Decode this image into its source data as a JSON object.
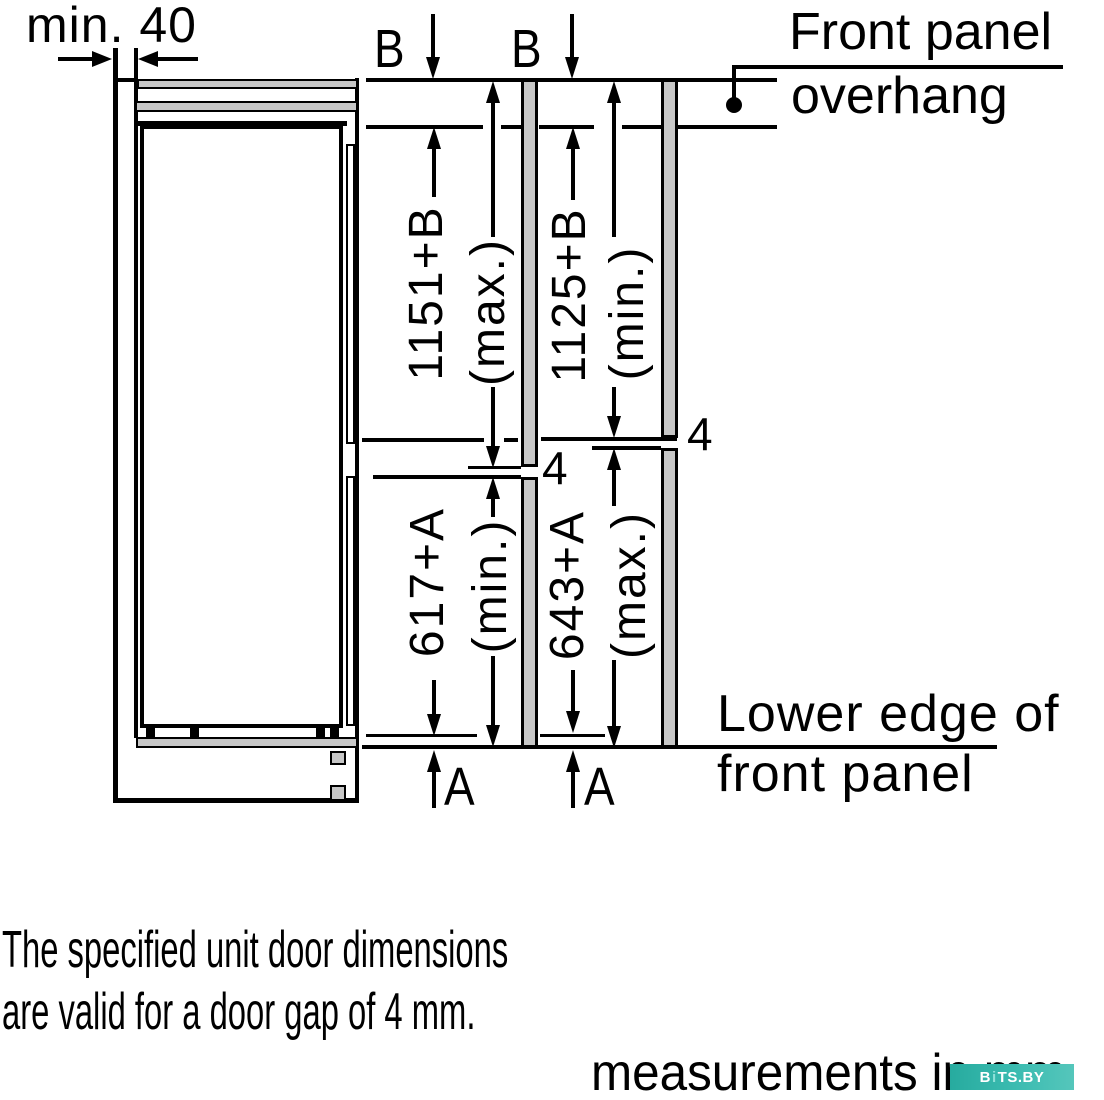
{
  "labels": {
    "min_clearance": "min. 40",
    "b": "B",
    "a": "A",
    "gap": "4"
  },
  "dimensions": {
    "upper_max_value": "1151+B",
    "upper_max_qual": "(max.)",
    "upper_min_value": "1125+B",
    "upper_min_qual": "(min.)",
    "lower_min_value": "617+A",
    "lower_min_qual": "(min.)",
    "lower_max_value": "643+A",
    "lower_max_qual": "(max.)"
  },
  "callouts": {
    "front_overhang_line1": "Front panel",
    "front_overhang_line2": "overhang",
    "lower_edge_line1": "Lower edge of",
    "lower_edge_line2": "front panel"
  },
  "notes": {
    "line1": "The specified unit door dimensions",
    "line2": "are valid for a door gap of 4 mm.",
    "units": "measurements in mm"
  },
  "watermark": {
    "part1": "B",
    "accent": "i",
    "part2": "TS.BY"
  },
  "colors": {
    "line": "#000000",
    "panel_gray": "#c7c7c7",
    "watermark_teal": "#2fb6ab"
  }
}
